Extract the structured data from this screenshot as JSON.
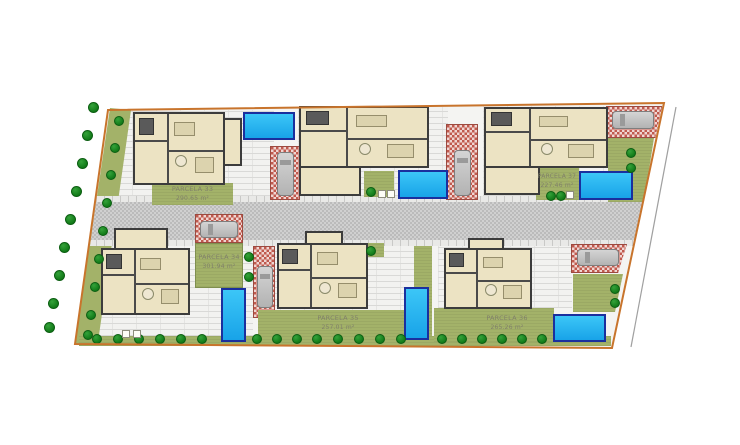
{
  "plan": {
    "kind": "residential site plan",
    "parcels": [
      {
        "id": "parcela-33",
        "name": "PARCELA 33",
        "area": "290.65 m²"
      },
      {
        "id": "parcela-34",
        "name": "PARCELA 34",
        "area": "301.94 m²"
      },
      {
        "id": "parcela-35",
        "name": "PARCELA 35",
        "area": "257.01 m²"
      },
      {
        "id": "parcela-36",
        "name": "PARCELA 36",
        "area": "265.26 m²"
      },
      {
        "id": "parcela-37",
        "name": "PARCELA 37",
        "area": "227.46 m²"
      }
    ],
    "colors": {
      "boundary": "#c8742c",
      "grass": "#a3b269",
      "tree": "#117a18",
      "pool_fill": "#2ab3f2",
      "pool_border": "#1a2f9e",
      "road": "#c7c7c7",
      "brick_driveway": "#c05a4e",
      "house_fill": "#ece3c3",
      "house_wall": "#3c3c3c",
      "label_text": "#80806a"
    }
  }
}
